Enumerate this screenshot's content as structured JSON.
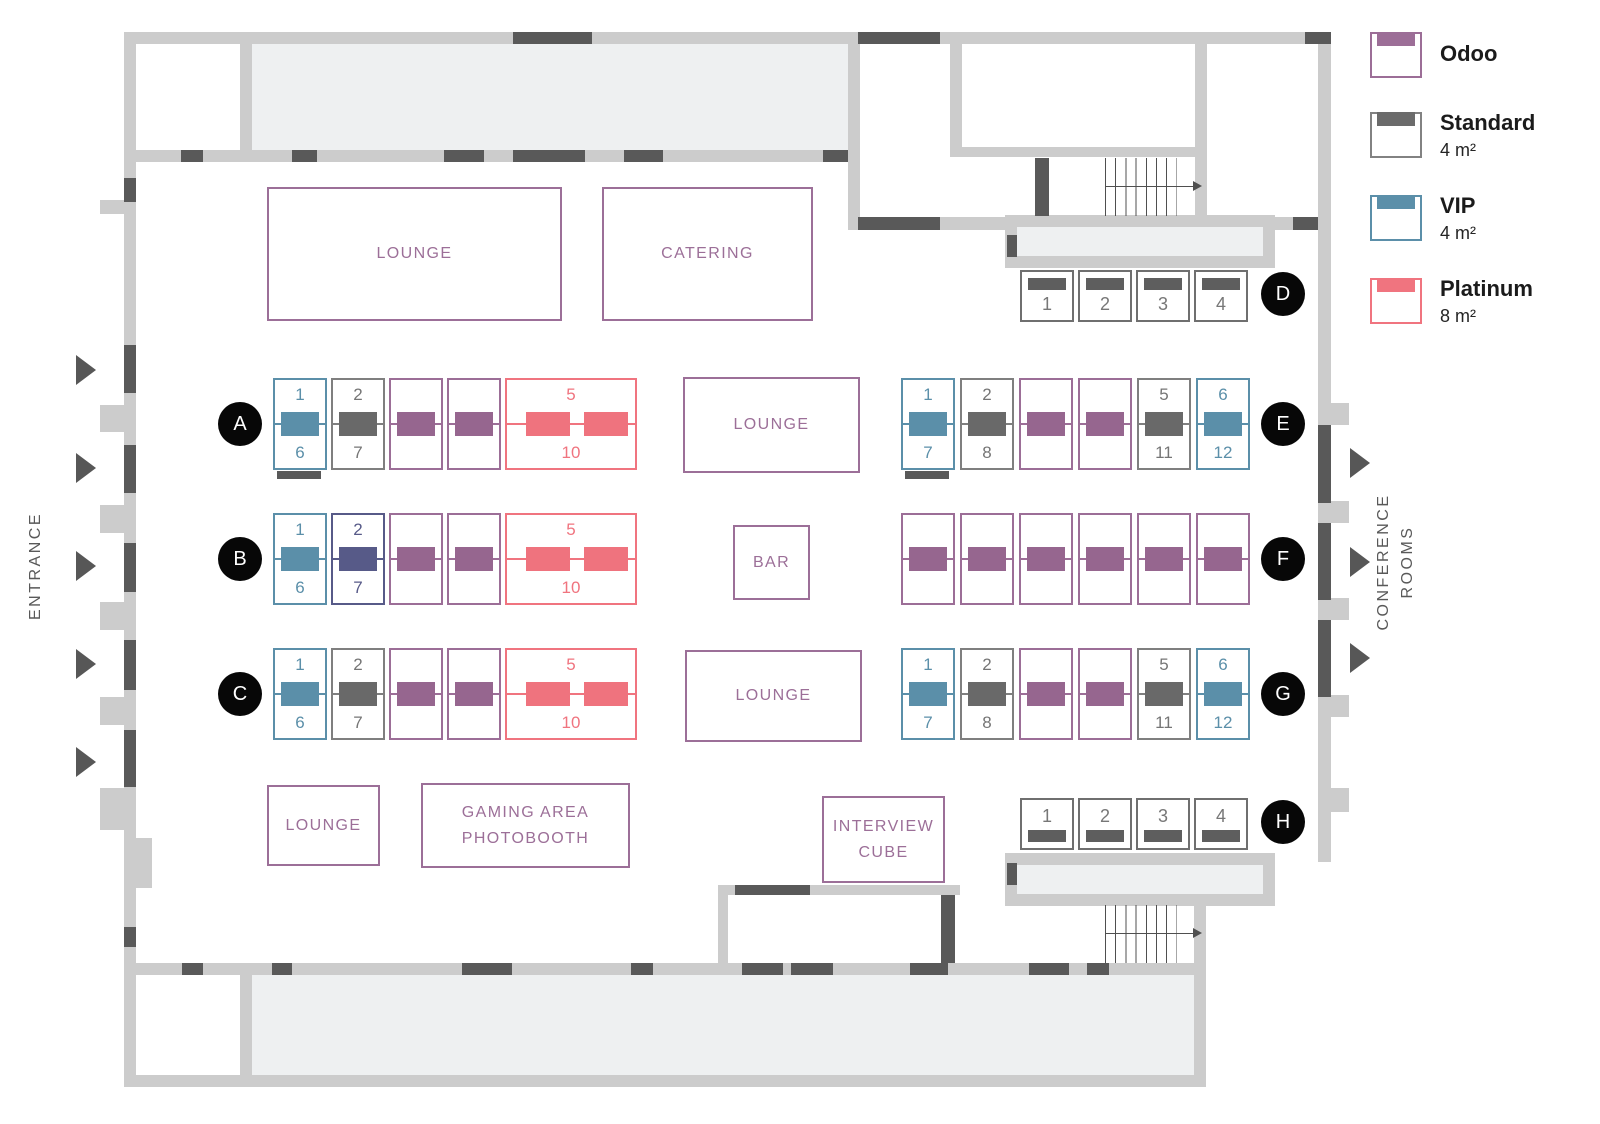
{
  "legend": {
    "items": [
      {
        "label": "Odoo",
        "size": "",
        "color": "#9c6e97"
      },
      {
        "label": "Standard",
        "size": "4 m²",
        "color": "#828282",
        "band": "#6b6b6b"
      },
      {
        "label": "VIP",
        "size": "4 m²",
        "color": "#5b8fa9"
      },
      {
        "label": "Platinum",
        "size": "8 m²",
        "color": "#f0747f"
      }
    ]
  },
  "labels": {
    "entrance": "ENTRANCE",
    "conference_lines": [
      "CONFERENCE",
      "ROOMS"
    ]
  },
  "areas": {
    "lounge_top": {
      "lines": [
        "LOUNGE"
      ]
    },
    "catering": {
      "lines": [
        "CATERING"
      ]
    },
    "lounge_center_top": {
      "lines": [
        "LOUNGE"
      ]
    },
    "bar": {
      "lines": [
        "BAR"
      ]
    },
    "lounge_center_bottom": {
      "lines": [
        "LOUNGE"
      ]
    },
    "lounge_bottom": {
      "lines": [
        "LOUNGE"
      ]
    },
    "gaming_area": {
      "lines": [
        "GAMING AREA",
        "PHOTOBOOTH"
      ]
    },
    "interview_cube": {
      "lines": [
        "INTERVIEW",
        "CUBE"
      ]
    }
  },
  "booth_colors": {
    "odoo": {
      "border": "#9c6e97",
      "fill": "#96668f"
    },
    "standard": {
      "border": "#7f7f7f",
      "fill": "#696969",
      "text": "#757575"
    },
    "vip": {
      "border": "#5b8fa9",
      "fill": "#5b8fa9"
    },
    "platinum": {
      "border": "#f0747f",
      "fill": "#ef737e"
    },
    "reserved": {
      "border": "#575a88",
      "fill": "#575a88"
    },
    "small": {
      "border": "#6f6f6f",
      "fill": "#5e5e5e",
      "text": "#777777"
    }
  },
  "map_colors": {
    "wall": "#cccccc",
    "door": "#595959",
    "room": "#eef0f1"
  },
  "rows": [
    {
      "id": "A",
      "booths": [
        {
          "type": "vip",
          "top": "1",
          "bottom": "6"
        },
        {
          "type": "standard",
          "top": "2",
          "bottom": "7"
        },
        {
          "type": "odoo"
        },
        {
          "type": "odoo"
        },
        {
          "type": "platinum",
          "top": "5",
          "bottom": "10"
        }
      ]
    },
    {
      "id": "B",
      "booths": [
        {
          "type": "vip",
          "top": "1",
          "bottom": "6"
        },
        {
          "type": "reserved",
          "top": "2",
          "bottom": "7"
        },
        {
          "type": "odoo"
        },
        {
          "type": "odoo"
        },
        {
          "type": "platinum",
          "top": "5",
          "bottom": "10"
        }
      ]
    },
    {
      "id": "C",
      "booths": [
        {
          "type": "vip",
          "top": "1",
          "bottom": "6"
        },
        {
          "type": "standard",
          "top": "2",
          "bottom": "7"
        },
        {
          "type": "odoo"
        },
        {
          "type": "odoo"
        },
        {
          "type": "platinum",
          "top": "5",
          "bottom": "10"
        }
      ]
    },
    {
      "id": "D",
      "booths": [
        {
          "type": "small",
          "num": "1"
        },
        {
          "type": "small",
          "num": "2"
        },
        {
          "type": "small",
          "num": "3"
        },
        {
          "type": "small",
          "num": "4"
        }
      ]
    },
    {
      "id": "E",
      "booths": [
        {
          "type": "vip",
          "top": "1",
          "bottom": "7"
        },
        {
          "type": "standard",
          "top": "2",
          "bottom": "8"
        },
        {
          "type": "odoo"
        },
        {
          "type": "odoo"
        },
        {
          "type": "standard",
          "top": "5",
          "bottom": "11"
        },
        {
          "type": "vip",
          "top": "6",
          "bottom": "12"
        }
      ]
    },
    {
      "id": "F",
      "booths": [
        {
          "type": "odoo"
        },
        {
          "type": "odoo"
        },
        {
          "type": "odoo"
        },
        {
          "type": "odoo"
        },
        {
          "type": "odoo"
        },
        {
          "type": "odoo"
        }
      ]
    },
    {
      "id": "G",
      "booths": [
        {
          "type": "vip",
          "top": "1",
          "bottom": "7"
        },
        {
          "type": "standard",
          "top": "2",
          "bottom": "8"
        },
        {
          "type": "odoo"
        },
        {
          "type": "odoo"
        },
        {
          "type": "standard",
          "top": "5",
          "bottom": "11"
        },
        {
          "type": "vip",
          "top": "6",
          "bottom": "12"
        }
      ]
    },
    {
      "id": "H",
      "booths": [
        {
          "type": "small",
          "num": "1"
        },
        {
          "type": "small",
          "num": "2"
        },
        {
          "type": "small",
          "num": "3"
        },
        {
          "type": "small",
          "num": "4"
        }
      ]
    }
  ]
}
